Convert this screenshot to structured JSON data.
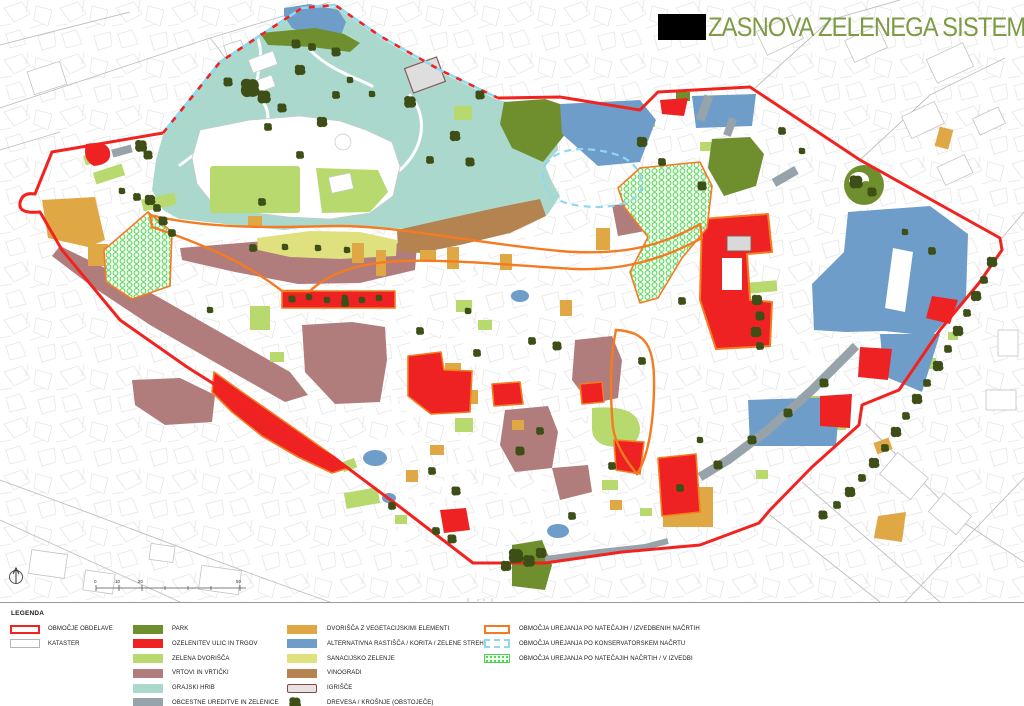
{
  "title": "ZASNOVA ZELENEGA SISTEMA",
  "legend": {
    "heading": "LEGENDA",
    "col1": [
      "OBMOČJE OBDELAVE",
      "KATASTER"
    ],
    "col2": [
      "PARK",
      "OZELENITEV ULIC IN TRGOV",
      "ZELENA DVORIŠČA",
      "VRTOVI IN VRTIČKI",
      "GRAJSKI HRIB",
      "OBCESTNE UREDITVE IN ZELENICE"
    ],
    "col3": [
      "DVORIŠČA Z VEGETACIJSKIMI ELEMENTI",
      "ALTERNATIVNA RASTIŠČA / KORITA / ZELENE STREHE",
      "SANACIJSKO ZELENJE",
      "VINOGRADI",
      "IGRIŠČE",
      "DREVESA / KROŠNJE (OBSTOJEČE)"
    ],
    "col4": [
      "OBMOČJA UREJANJA PO NATEČAJIH / IZVEDBENIH NAČRTIH",
      "OBMOČJA UREJANJA PO KONSERVATORSKEM NAČRTU",
      "OBMOČJA UREJANJA PO NATEČAJIH NAČRTIH / V IZVEDBI"
    ]
  },
  "map": {
    "scale_ticks": [
      "0",
      "10",
      "20",
      "50"
    ]
  },
  "colors": {
    "boundary_red": "#f2231f",
    "competition_orange": "#f47b20",
    "park_olive": "#6f8f2f",
    "green_courtyards": "#b8d96e",
    "gardens_mauve": "#b17c7c",
    "castle_hill_teal": "#abd8cd",
    "roadside_gray": "#97a3ab",
    "courtyards_tan": "#dfa845",
    "alternative_blue": "#6e9dc9",
    "remediation_pale": "#dfe07e",
    "vineyards_brown": "#b5834f",
    "trees_dark_olive": "#3d4e16",
    "conservation_dash_blue": "#8fd9f0",
    "title_green": "#7d9b44"
  }
}
